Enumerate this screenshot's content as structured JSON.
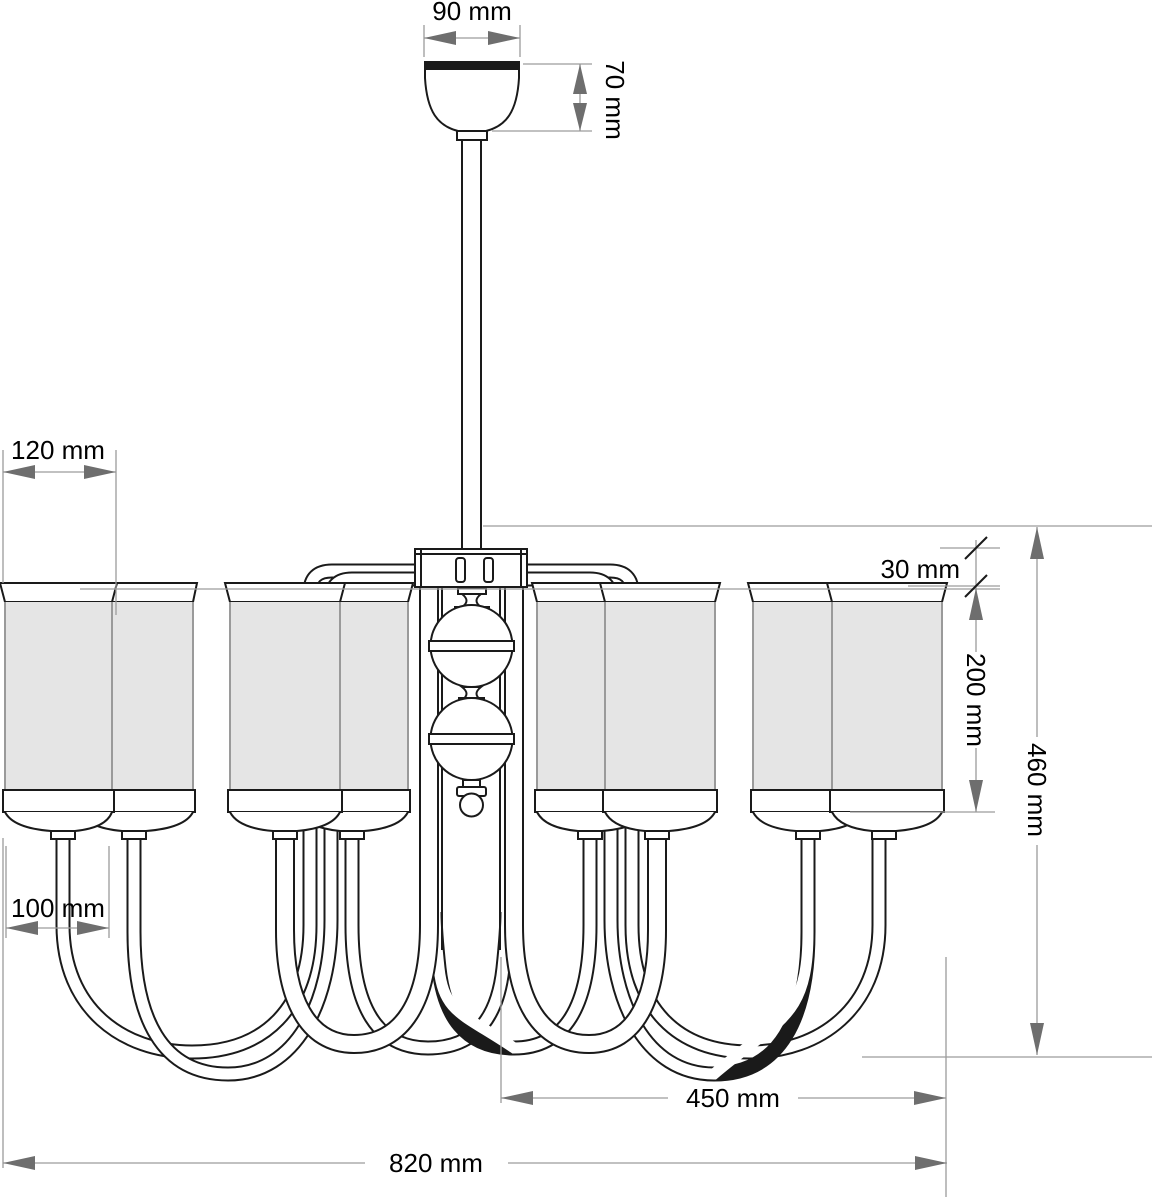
{
  "drawing": {
    "type": "technical dimension drawing",
    "subject": "eight-arm chandelier with cylindrical shades, front elevation",
    "units": "mm"
  },
  "style": {
    "line_color": "#1a1a1a",
    "dimension_line_color": "#9c9c9c",
    "arrow_color": "#6e6e6e",
    "shade_fill": "#e5e5e5",
    "background": "#ffffff",
    "text_color": "#000000"
  },
  "components": [
    "ceiling-canopy",
    "suspension-rod",
    "hub-plate",
    "decorative-spheres",
    "curved-arms",
    "cylindrical-shades"
  ],
  "dimensions": {
    "canopy_width": {
      "label": "90 mm",
      "value": 90,
      "orientation": "horizontal"
    },
    "canopy_height": {
      "label": "70 mm",
      "value": 70,
      "orientation": "vertical"
    },
    "shade_diameter": {
      "label": "120 mm",
      "value": 120,
      "orientation": "horizontal"
    },
    "rim_offset": {
      "label": "30 mm",
      "value": 30,
      "orientation": "vertical"
    },
    "shade_height": {
      "label": "200 mm",
      "value": 200,
      "orientation": "vertical"
    },
    "body_height": {
      "label": "460 mm",
      "value": 460,
      "orientation": "vertical"
    },
    "arm_offset": {
      "label": "100 mm",
      "value": 100,
      "orientation": "horizontal"
    },
    "inner_span": {
      "label": "450 mm",
      "value": 450,
      "orientation": "horizontal"
    },
    "total_width": {
      "label": "820 mm",
      "value": 820,
      "orientation": "horizontal"
    }
  }
}
